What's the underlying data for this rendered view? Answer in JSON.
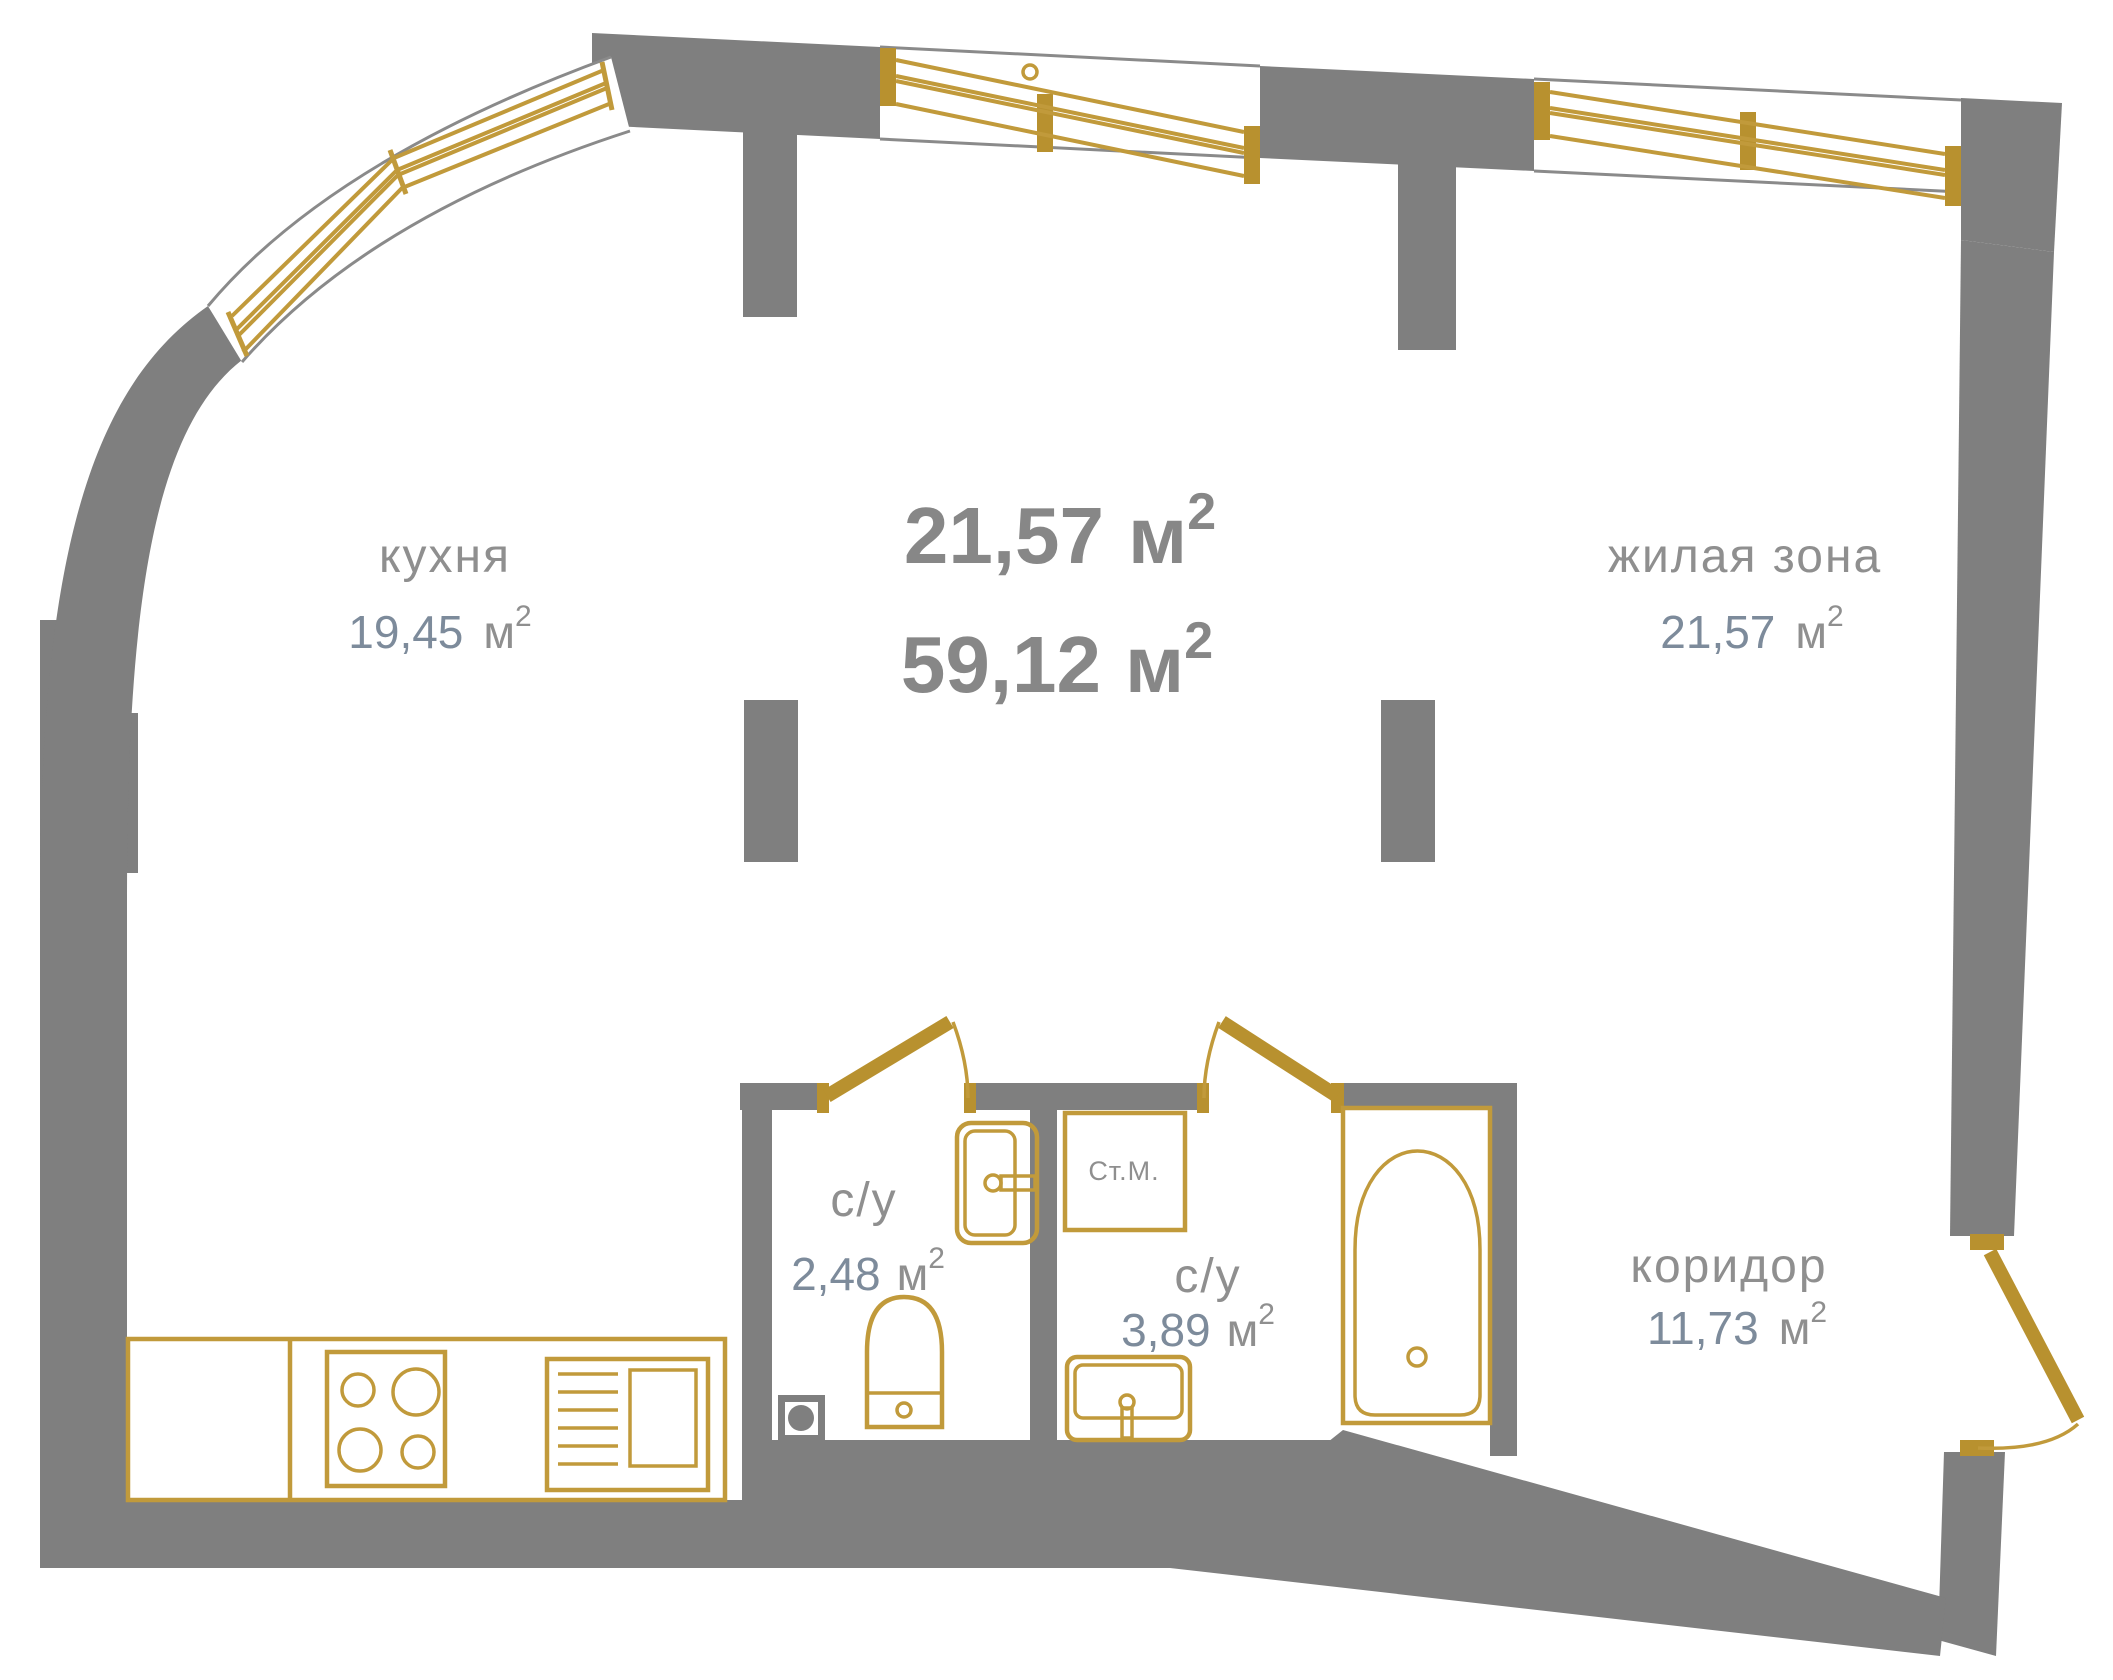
{
  "plan": {
    "type": "apartment-floor-plan",
    "language": "ru",
    "totals": {
      "area_living": "21,57",
      "area_total": "59,12"
    },
    "units": {
      "meter": "м",
      "sup": "2"
    },
    "rooms": [
      {
        "id": "kitchen",
        "name": "кухня",
        "area": "19,45"
      },
      {
        "id": "living",
        "name": "жилая зона",
        "area": "21,57"
      },
      {
        "id": "bath1",
        "name": "с/у",
        "area": "2,48"
      },
      {
        "id": "bath2",
        "name": "с/у",
        "area": "3,89"
      },
      {
        "id": "corridor",
        "name": "коридор",
        "area": "11,73"
      }
    ],
    "appliances": {
      "washing_machine": "Ст.М."
    },
    "colors": {
      "walls": "#7f7f7f",
      "gold": "#c19a3b",
      "room_labels": "#8f8f8f",
      "area_numbers": "#7d8b9b",
      "total_numbers": "#878787",
      "background": "#ffffff"
    }
  }
}
